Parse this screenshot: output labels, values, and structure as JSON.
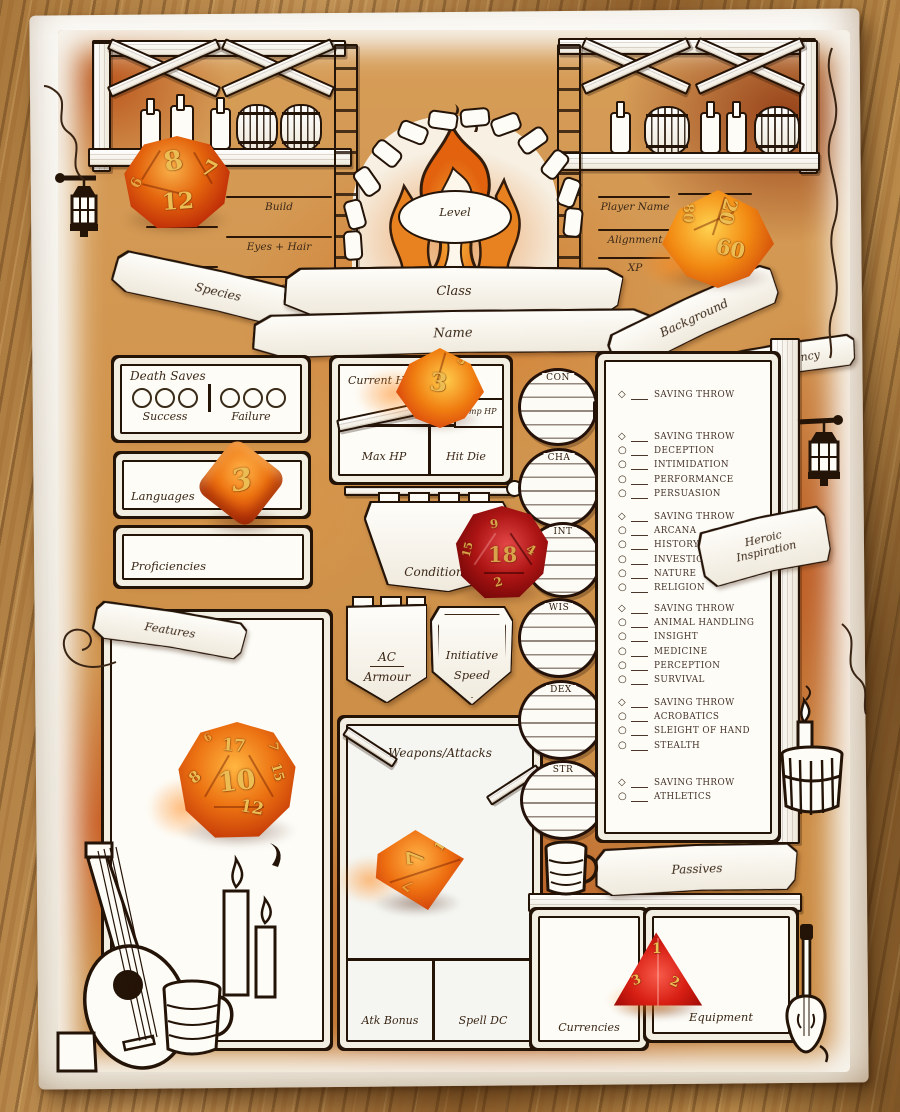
{
  "header": {
    "left_fields": [
      "Build",
      "Eyes + Hair",
      "Gender"
    ],
    "right_fields": [
      "Player Name",
      "Alignment",
      "XP"
    ],
    "level_label": "Level",
    "banners": {
      "species": "Species",
      "class": "Class",
      "name": "Name",
      "background": "Background",
      "proficiency": "Proficiency"
    }
  },
  "death_saves": {
    "title": "Death Saves",
    "success_label": "Success",
    "failure_label": "Failure"
  },
  "left_boxes": {
    "languages": "Languages",
    "proficiencies": "Proficiencies",
    "features": "Features"
  },
  "hp": {
    "current": "Current HP",
    "temp": "Temp HP",
    "max": "Max HP",
    "hit_die": "Hit Die"
  },
  "center": {
    "conditions": "Conditions",
    "ac": "AC",
    "armour": "Armour",
    "initiative": "Initiative",
    "speed": "Speed",
    "weapons": "Weapons/Attacks",
    "atk_bonus": "Atk Bonus",
    "spell_dc": "Spell DC"
  },
  "inspiration": {
    "line1": "Heroic",
    "line2": "Inspiration"
  },
  "abilities": [
    "CON",
    "CHA",
    "INT",
    "WIS",
    "DEX",
    "STR"
  ],
  "skills": {
    "groups": [
      {
        "ability": "CON",
        "rows": [
          {
            "marker": "diamond",
            "label": "SAVING THROW"
          }
        ]
      },
      {
        "ability": "CHA",
        "rows": [
          {
            "marker": "diamond",
            "label": "SAVING THROW"
          },
          {
            "marker": "circle",
            "label": "DECEPTION"
          },
          {
            "marker": "circle",
            "label": "INTIMIDATION"
          },
          {
            "marker": "circle",
            "label": "PERFORMANCE"
          },
          {
            "marker": "circle",
            "label": "PERSUASION"
          }
        ]
      },
      {
        "ability": "INT",
        "rows": [
          {
            "marker": "diamond",
            "label": "SAVING THROW"
          },
          {
            "marker": "circle",
            "label": "ARCANA"
          },
          {
            "marker": "circle",
            "label": "HISTORY"
          },
          {
            "marker": "circle",
            "label": "INVESTIGATION"
          },
          {
            "marker": "circle",
            "label": "NATURE"
          },
          {
            "marker": "circle",
            "label": "RELIGION"
          }
        ]
      },
      {
        "ability": "WIS",
        "rows": [
          {
            "marker": "diamond",
            "label": "SAVING THROW"
          },
          {
            "marker": "circle",
            "label": "ANIMAL HANDLING"
          },
          {
            "marker": "circle",
            "label": "INSIGHT"
          },
          {
            "marker": "circle",
            "label": "MEDICINE"
          },
          {
            "marker": "circle",
            "label": "PERCEPTION"
          },
          {
            "marker": "circle",
            "label": "SURVIVAL"
          }
        ]
      },
      {
        "ability": "DEX",
        "rows": [
          {
            "marker": "diamond",
            "label": "SAVING THROW"
          },
          {
            "marker": "circle",
            "label": "ACROBATICS"
          },
          {
            "marker": "circle",
            "label": "SLEIGHT OF HAND"
          },
          {
            "marker": "circle",
            "label": "STEALTH"
          }
        ]
      },
      {
        "ability": "STR",
        "rows": [
          {
            "marker": "diamond",
            "label": "SAVING THROW"
          },
          {
            "marker": "circle",
            "label": "ATHLETICS"
          }
        ]
      }
    ]
  },
  "bottom": {
    "passives": "Passives",
    "currencies": "Currencies",
    "equipment": "Equipment"
  },
  "dice": [
    {
      "name": "d12-orange",
      "numbers": [
        "8",
        "7",
        "12",
        "6"
      ]
    },
    {
      "name": "d10-percentile-orange",
      "numbers": [
        "20",
        "80",
        "60"
      ]
    },
    {
      "name": "d10-orange",
      "numbers": [
        "3",
        "5"
      ]
    },
    {
      "name": "d6-orange",
      "numbers": [
        "3"
      ]
    },
    {
      "name": "d20-dark-red",
      "numbers": [
        "18",
        "9",
        "4",
        "2",
        "15"
      ]
    },
    {
      "name": "d20-orange",
      "numbers": [
        "10",
        "17",
        "12",
        "8",
        "15",
        "7",
        "6"
      ]
    },
    {
      "name": "d8-orange",
      "numbers": [
        "7",
        "1",
        "7"
      ]
    },
    {
      "name": "d4-red",
      "numbers": [
        "1",
        "3",
        "2"
      ]
    }
  ],
  "colors": {
    "ink": "#241307",
    "wash_orange": "#c4702c",
    "paper": "#f8f6f0",
    "dice_orange": "#e2680f",
    "dice_red": "#a31212",
    "dice_numerals": "#ecbd52",
    "table_wood": "#a87c42"
  }
}
